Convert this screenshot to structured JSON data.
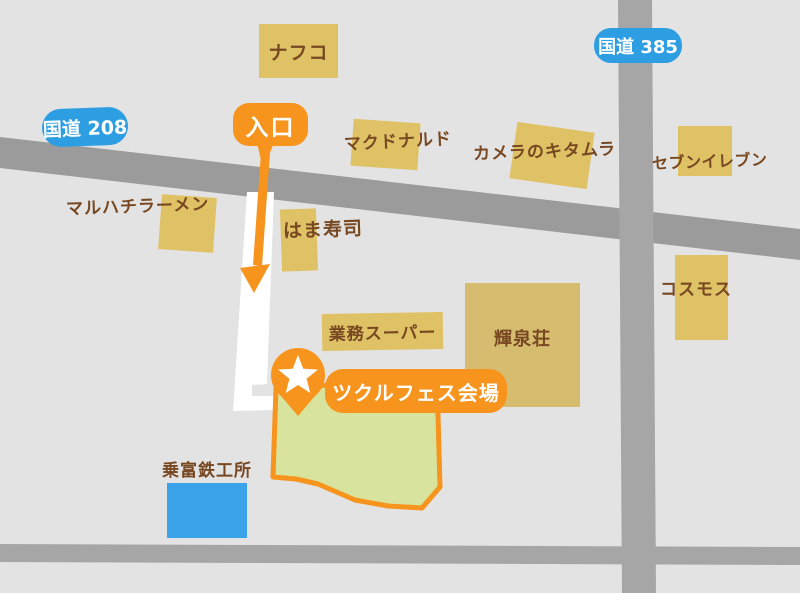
{
  "title": "ツクルフェス会場 案内マップ",
  "badges": {
    "route208": "国道 208",
    "route385": "国道 385",
    "entrance": "入口",
    "venue": "ツクルフェス会場"
  },
  "buildings": {
    "nafco": "ナフコ",
    "mcdonalds": "マクドナルド",
    "kitamura": "カメラのキタムラ",
    "seven_eleven": "セブンイレブン",
    "maruhachi_ramen": "マルハチラーメン",
    "hamazushi": "はま寿司",
    "gyomu_super": "業務スーパー",
    "kisenso": "輝泉荘",
    "cosmos": "コスモス",
    "noritomi": "乗富鉄工所"
  },
  "markers": {
    "star_pin": "venue-location-star-pin",
    "entrance_arrow": "entrance-direction-arrow-down"
  },
  "colors": {
    "background": "#E3E3E3",
    "road_gray": "#9B9B9B",
    "road_gray_light": "#A6A6A6",
    "access_road_white": "#FFFFFF",
    "building_tan": "#DFC266",
    "building_tan_muted": "#D6BC6E",
    "label_brown": "#774821",
    "badge_blue": "#2E9EE3",
    "accent_orange": "#F7941D",
    "venue_green_fill": "#D8E49D",
    "water_blue": "#3BA3EA",
    "badge_text_white": "#FFFFFF"
  }
}
